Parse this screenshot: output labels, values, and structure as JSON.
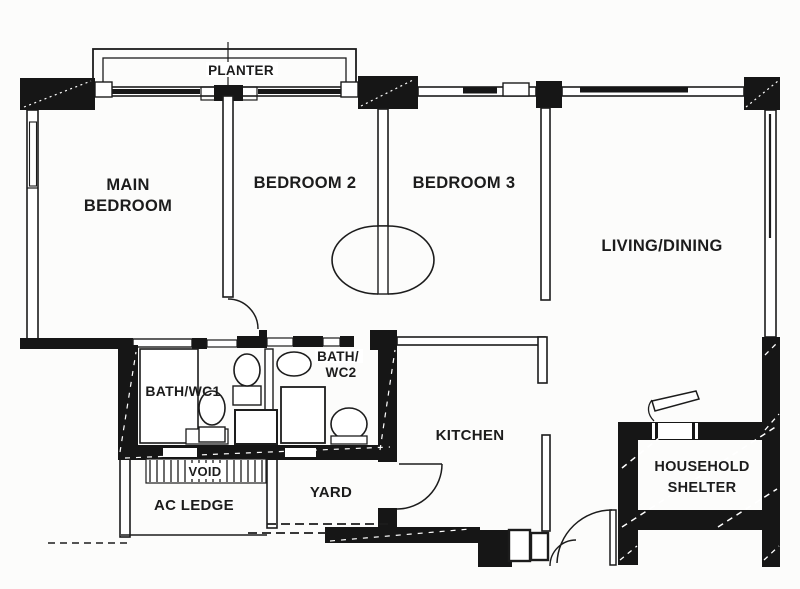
{
  "colors": {
    "wall": "#161616",
    "ink": "#1c1c1c",
    "paper": "#fcfcfb"
  },
  "labels": {
    "planter": "PLANTER",
    "main_bedroom": [
      "MAIN",
      "BEDROOM"
    ],
    "bedroom2": "BEDROOM 2",
    "bedroom3": "BEDROOM 3",
    "living_dining": "LIVING/DINING",
    "bath_wc1": "BATH/WC1",
    "bath_wc2": [
      "BATH/",
      "WC2"
    ],
    "kitchen": "KITCHEN",
    "void_label": "VOID",
    "ac_ledge": "AC LEDGE",
    "yard": "YARD",
    "household_shelter": [
      "HOUSEHOLD",
      "SHELTER"
    ]
  }
}
